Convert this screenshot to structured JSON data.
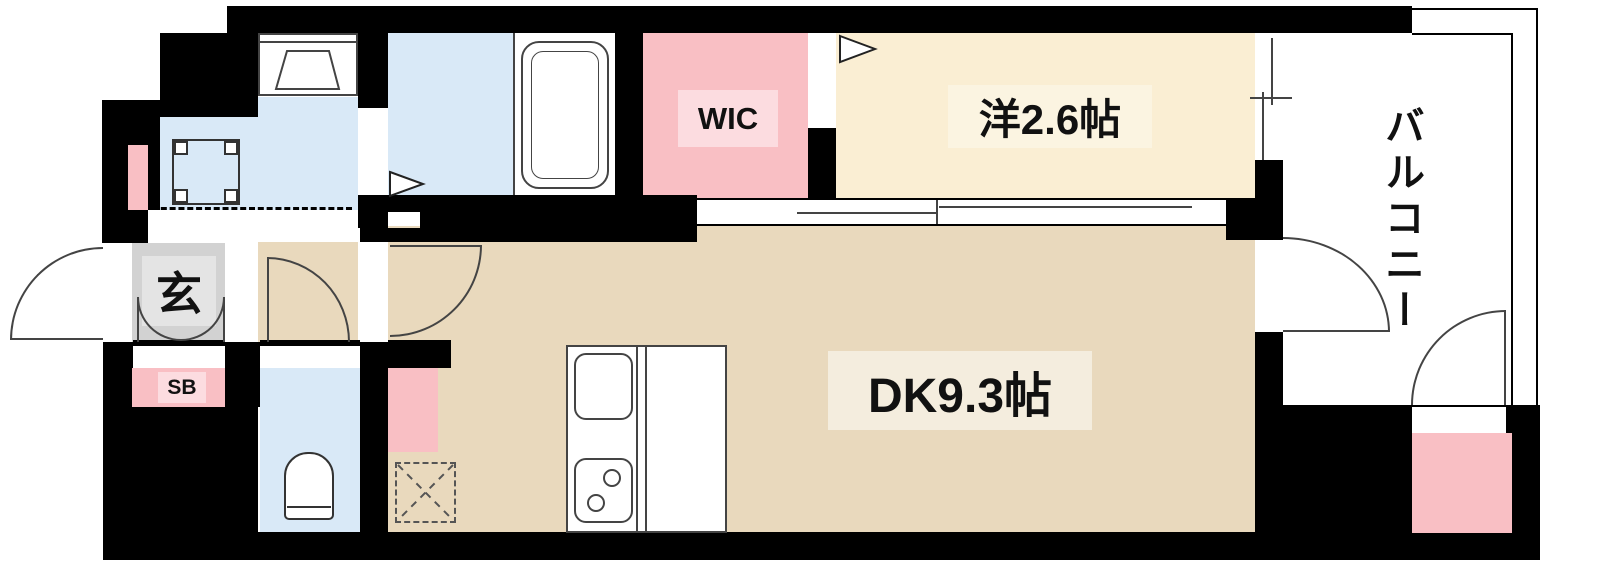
{
  "plan": {
    "title": "apartment-floor-plan",
    "rooms": {
      "wic": "WIC",
      "western": "洋2.6帖",
      "dk": "DK9.3帖",
      "balcony": "バルコニー",
      "entrance": "玄",
      "shoebox": "SB"
    },
    "fixtures": [
      "washbasin",
      "washing-machine-pan",
      "bathtub",
      "toilet",
      "kitchen-sink",
      "gas-stove",
      "floor-hatch"
    ],
    "colors": {
      "wall": "#000000",
      "wet_blue": "#d9e9f7",
      "pink": "#f9bfc4",
      "pink_label": "#fcdce0",
      "cream": "#faeed3",
      "cream_label": "#fbf4e1",
      "tan": "#e9d9bd",
      "tan_label": "#f4edde",
      "entrance_gray": "#d2d2d2",
      "entrance_gray_inner": "#e4e4e4",
      "line": "#444444"
    }
  }
}
